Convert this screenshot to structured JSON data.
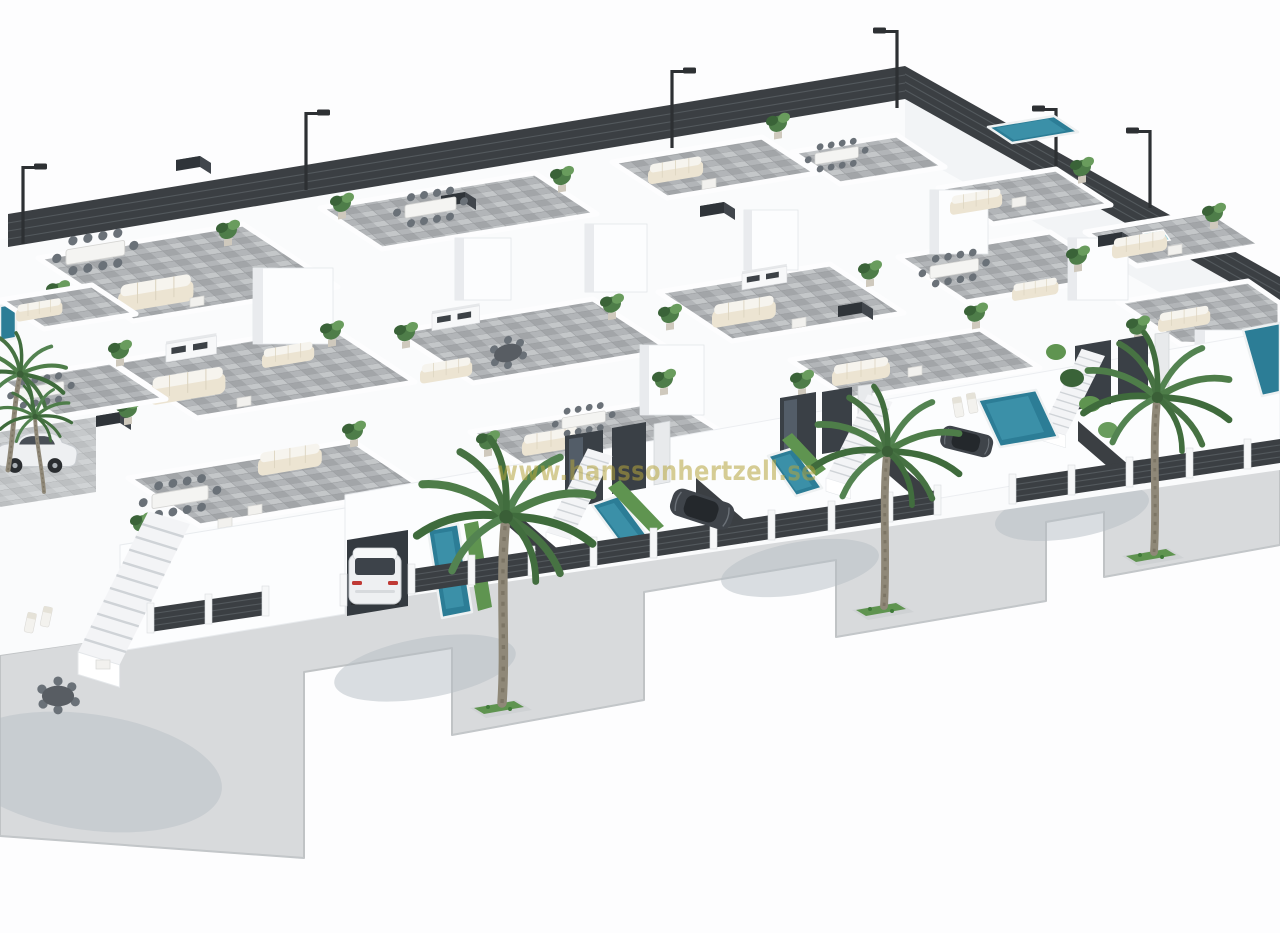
{
  "image": {
    "type": "3D architectural rendering",
    "subject": "Aerial three-quarter view of a residential development of white villas with grey-tiled roof terraces, outdoor furniture, private pools, dark slatted privacy fences, street palm trees and a light concrete sidewalk on a pure white background"
  },
  "watermark": {
    "text": "www.hanssonhertzell.se",
    "color": "#b4a43c",
    "opacity": 0.55
  },
  "scene": {
    "street_palm_trees": 3,
    "street_lamps": 6,
    "cars_visible": 4,
    "swimming_pools_visible": 7,
    "fence_style": "dark horizontal slats with white piers",
    "sidewalk_style": "light concrete band with stepped edge and square palm planters"
  },
  "colors": {
    "background": "#fdfdfe",
    "wall_white": "#fbfcfd",
    "wall_shade": "#e9ebee",
    "terrace_tile": "#b2b5b8",
    "terrace_tile_light": "#c4c7c9",
    "terrace_tile_dark": "#a2a5a8",
    "pavement": "#d8dadc",
    "pavement_edge": "#c0c3c5",
    "fence_dark": "#3b3f43",
    "fence_slat": "#575c61",
    "pool_water": "#2c7d96",
    "pool_light": "#49a0b8",
    "glass_dark": "#3a4046",
    "glass_light": "#5a6470",
    "door_light": "#e8eaec",
    "plant_green": "#4e7d49",
    "plant_dark": "#3a6338",
    "plant_light": "#699c5d",
    "palm_trunk": "#8f8878",
    "furniture_cream": "#ece4d2",
    "furniture_white": "#f6f4ee",
    "chair_gray": "#6a7178",
    "car_white": "#eef0f2",
    "car_dark": "#3f444a",
    "lamp_black": "#2d3033",
    "planter_grass": "#5f9450",
    "shadow": "#b6bdc4",
    "watermark": "#b4a43c"
  }
}
